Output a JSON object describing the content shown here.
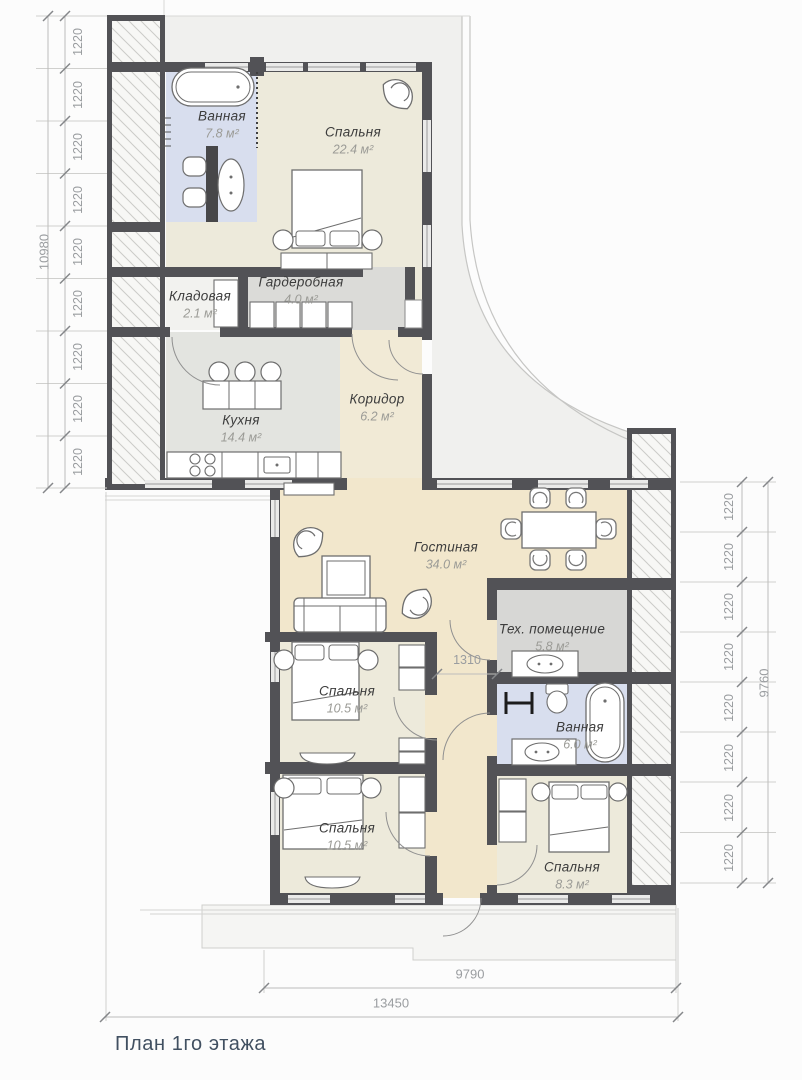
{
  "title": "План 1го этажа",
  "rooms": {
    "bathroom_top": {
      "name": "Ванная",
      "area": "7.8 м²"
    },
    "bedroom_top": {
      "name": "Спальня",
      "area": "22.4 м²"
    },
    "wardrobe": {
      "name": "Гардеробная",
      "area": "4.0 м²"
    },
    "storage": {
      "name": "Кладовая",
      "area": "2.1 м²"
    },
    "kitchen": {
      "name": "Кухня",
      "area": "14.4 м²"
    },
    "corridor": {
      "name": "Коридор",
      "area": "6.2 м²"
    },
    "living": {
      "name": "Гостиная",
      "area": "34.0 м²"
    },
    "tech": {
      "name": "Тех. помещение",
      "area": "5.8 м²"
    },
    "bedroom_mid": {
      "name": "Спальня",
      "area": "10.5 м²"
    },
    "bathroom_low": {
      "name": "Ванная",
      "area": "6.0 м²"
    },
    "bedroom_low_left": {
      "name": "Спальня",
      "area": "10.5 м²"
    },
    "bedroom_low_right": {
      "name": "Спальня",
      "area": "8.3 м²"
    }
  },
  "dimensions": {
    "segment": "1220",
    "left_total": "10980",
    "right_total": "9760",
    "bottom_inner": "9790",
    "bottom_outer": "13450",
    "hall_width": "1310",
    "left_segments": 9,
    "right_segments": 8
  },
  "colors": {
    "wall": "#525256",
    "bath_floor": "#d8deee",
    "bedroom_floor": "#edeadb",
    "living_floor": "#f2e7cc",
    "kitchen_floor": "#e3e4e0",
    "tech_floor": "#d7d7d5",
    "wardrobe_floor": "#dbdbd8",
    "site_area": "#f0f0ee",
    "dim_text": "#9a9da0",
    "title_text": "#415061"
  }
}
